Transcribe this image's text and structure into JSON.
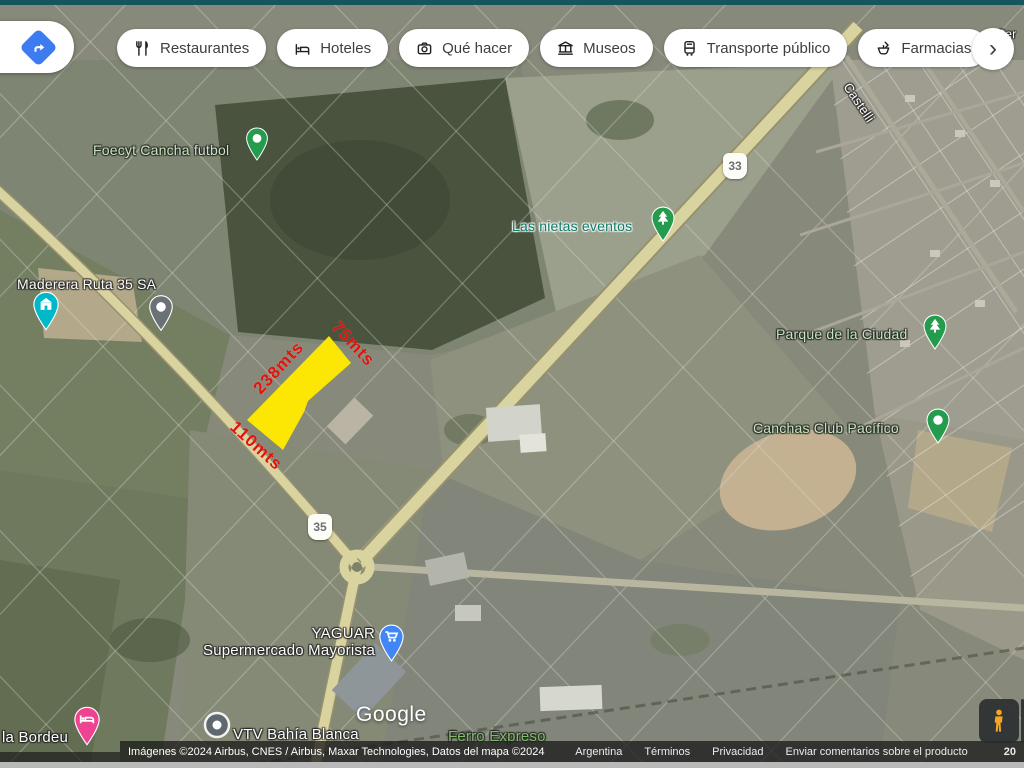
{
  "toolbar": {
    "directions_button": {
      "icon": "directions-icon",
      "color": "#3d7bf0"
    },
    "chips": [
      {
        "label": "Restaurantes",
        "icon": "restaurant-icon"
      },
      {
        "label": "Hoteles",
        "icon": "hotel-icon"
      },
      {
        "label": "Qué hacer",
        "icon": "camera-icon"
      },
      {
        "label": "Museos",
        "icon": "museum-icon"
      },
      {
        "label": "Transporte público",
        "icon": "transit-icon"
      },
      {
        "label": "Farmacias",
        "icon": "pharmacy-icon"
      }
    ],
    "more_chevron": "›"
  },
  "map": {
    "place_labels": {
      "foecyt": "Foecyt Cancha futbol",
      "las_nietas": "Las nietas eventos",
      "maderera": "Maderera Ruta 35 SA",
      "parque": "Parque de la Ciudad",
      "canchas": "Canchas Club Pacífico",
      "yaguar_line1": "YAGUAR",
      "yaguar_line2": "Supermercado Mayorista",
      "vtv": "VTV Bahía Blanca",
      "ferro": "Ferro Expreso",
      "bordeu": "la Bordeu",
      "castelli": "Castelli",
      "partial_topright": "Ser"
    },
    "route_shields": {
      "r33": "33",
      "r35": "35"
    },
    "watermark": "Google",
    "pin_colors": {
      "place": "#259b4e",
      "store": "#00b8c8",
      "cart": "#4285f4",
      "bed": "#ee4391",
      "gray": "#6b7276"
    }
  },
  "property_overlay": {
    "fill": "#ffe900",
    "dim_color": "#e3120b",
    "side_length": "238mts",
    "top_length": "75mts",
    "bottom_length": "110mts"
  },
  "attribution": {
    "imagery": "Imágenes ©2024 Airbus, CNES / Airbus, Maxar Technologies, Datos del mapa ©2024",
    "links": [
      "Argentina",
      "Términos",
      "Privacidad",
      "Enviar comentarios sobre el producto"
    ],
    "scale_partial": "20"
  }
}
